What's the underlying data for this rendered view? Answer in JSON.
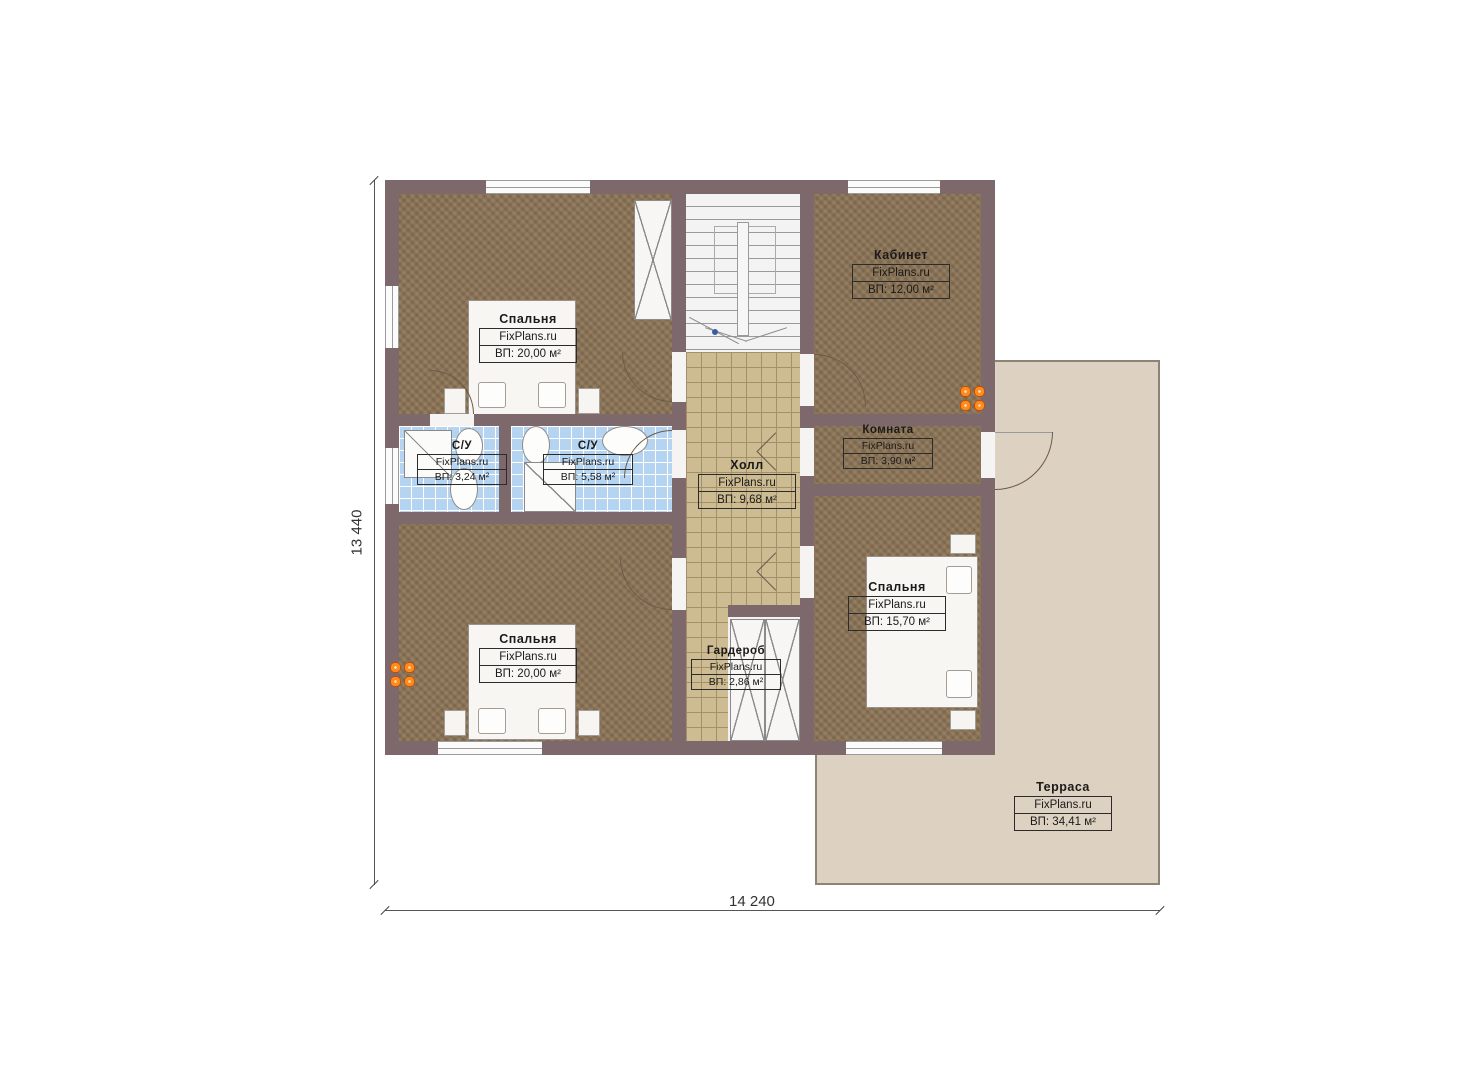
{
  "watermark": "FixPlans.ru",
  "dimensions": {
    "vertical": "13 440",
    "horizontal": "14 240"
  },
  "colors": {
    "wall": "#7d696b",
    "wood_floor": "#8a7254",
    "hall_tile": "#cdbb92",
    "bathroom_tile": "#b5d4f2",
    "terrace": "#ddd2c1",
    "radiator": "#ff8a1e"
  },
  "rooms": [
    {
      "id": "bedroom-top-left",
      "name": "Спальня",
      "area": "ВП: 20,00 м²"
    },
    {
      "id": "study",
      "name": "Кабинет",
      "area": "ВП: 12,00 м²"
    },
    {
      "id": "bathroom-small",
      "name": "С/У",
      "area": "ВП: 3,24 м²"
    },
    {
      "id": "bathroom-large",
      "name": "С/У",
      "area": "ВП: 5,58 м²"
    },
    {
      "id": "hall",
      "name": "Холл",
      "area": "ВП: 9,68 м²"
    },
    {
      "id": "room",
      "name": "Комната",
      "area": "ВП: 3,90 м²"
    },
    {
      "id": "bedroom-bottom-left",
      "name": "Спальня",
      "area": "ВП: 20,00 м²"
    },
    {
      "id": "wardrobe",
      "name": "Гардероб",
      "area": "ВП: 2,86 м²"
    },
    {
      "id": "bedroom-right",
      "name": "Спальня",
      "area": "ВП: 15,70 м²"
    },
    {
      "id": "terrace",
      "name": "Терраса",
      "area": "ВП: 34,41 м²"
    }
  ]
}
